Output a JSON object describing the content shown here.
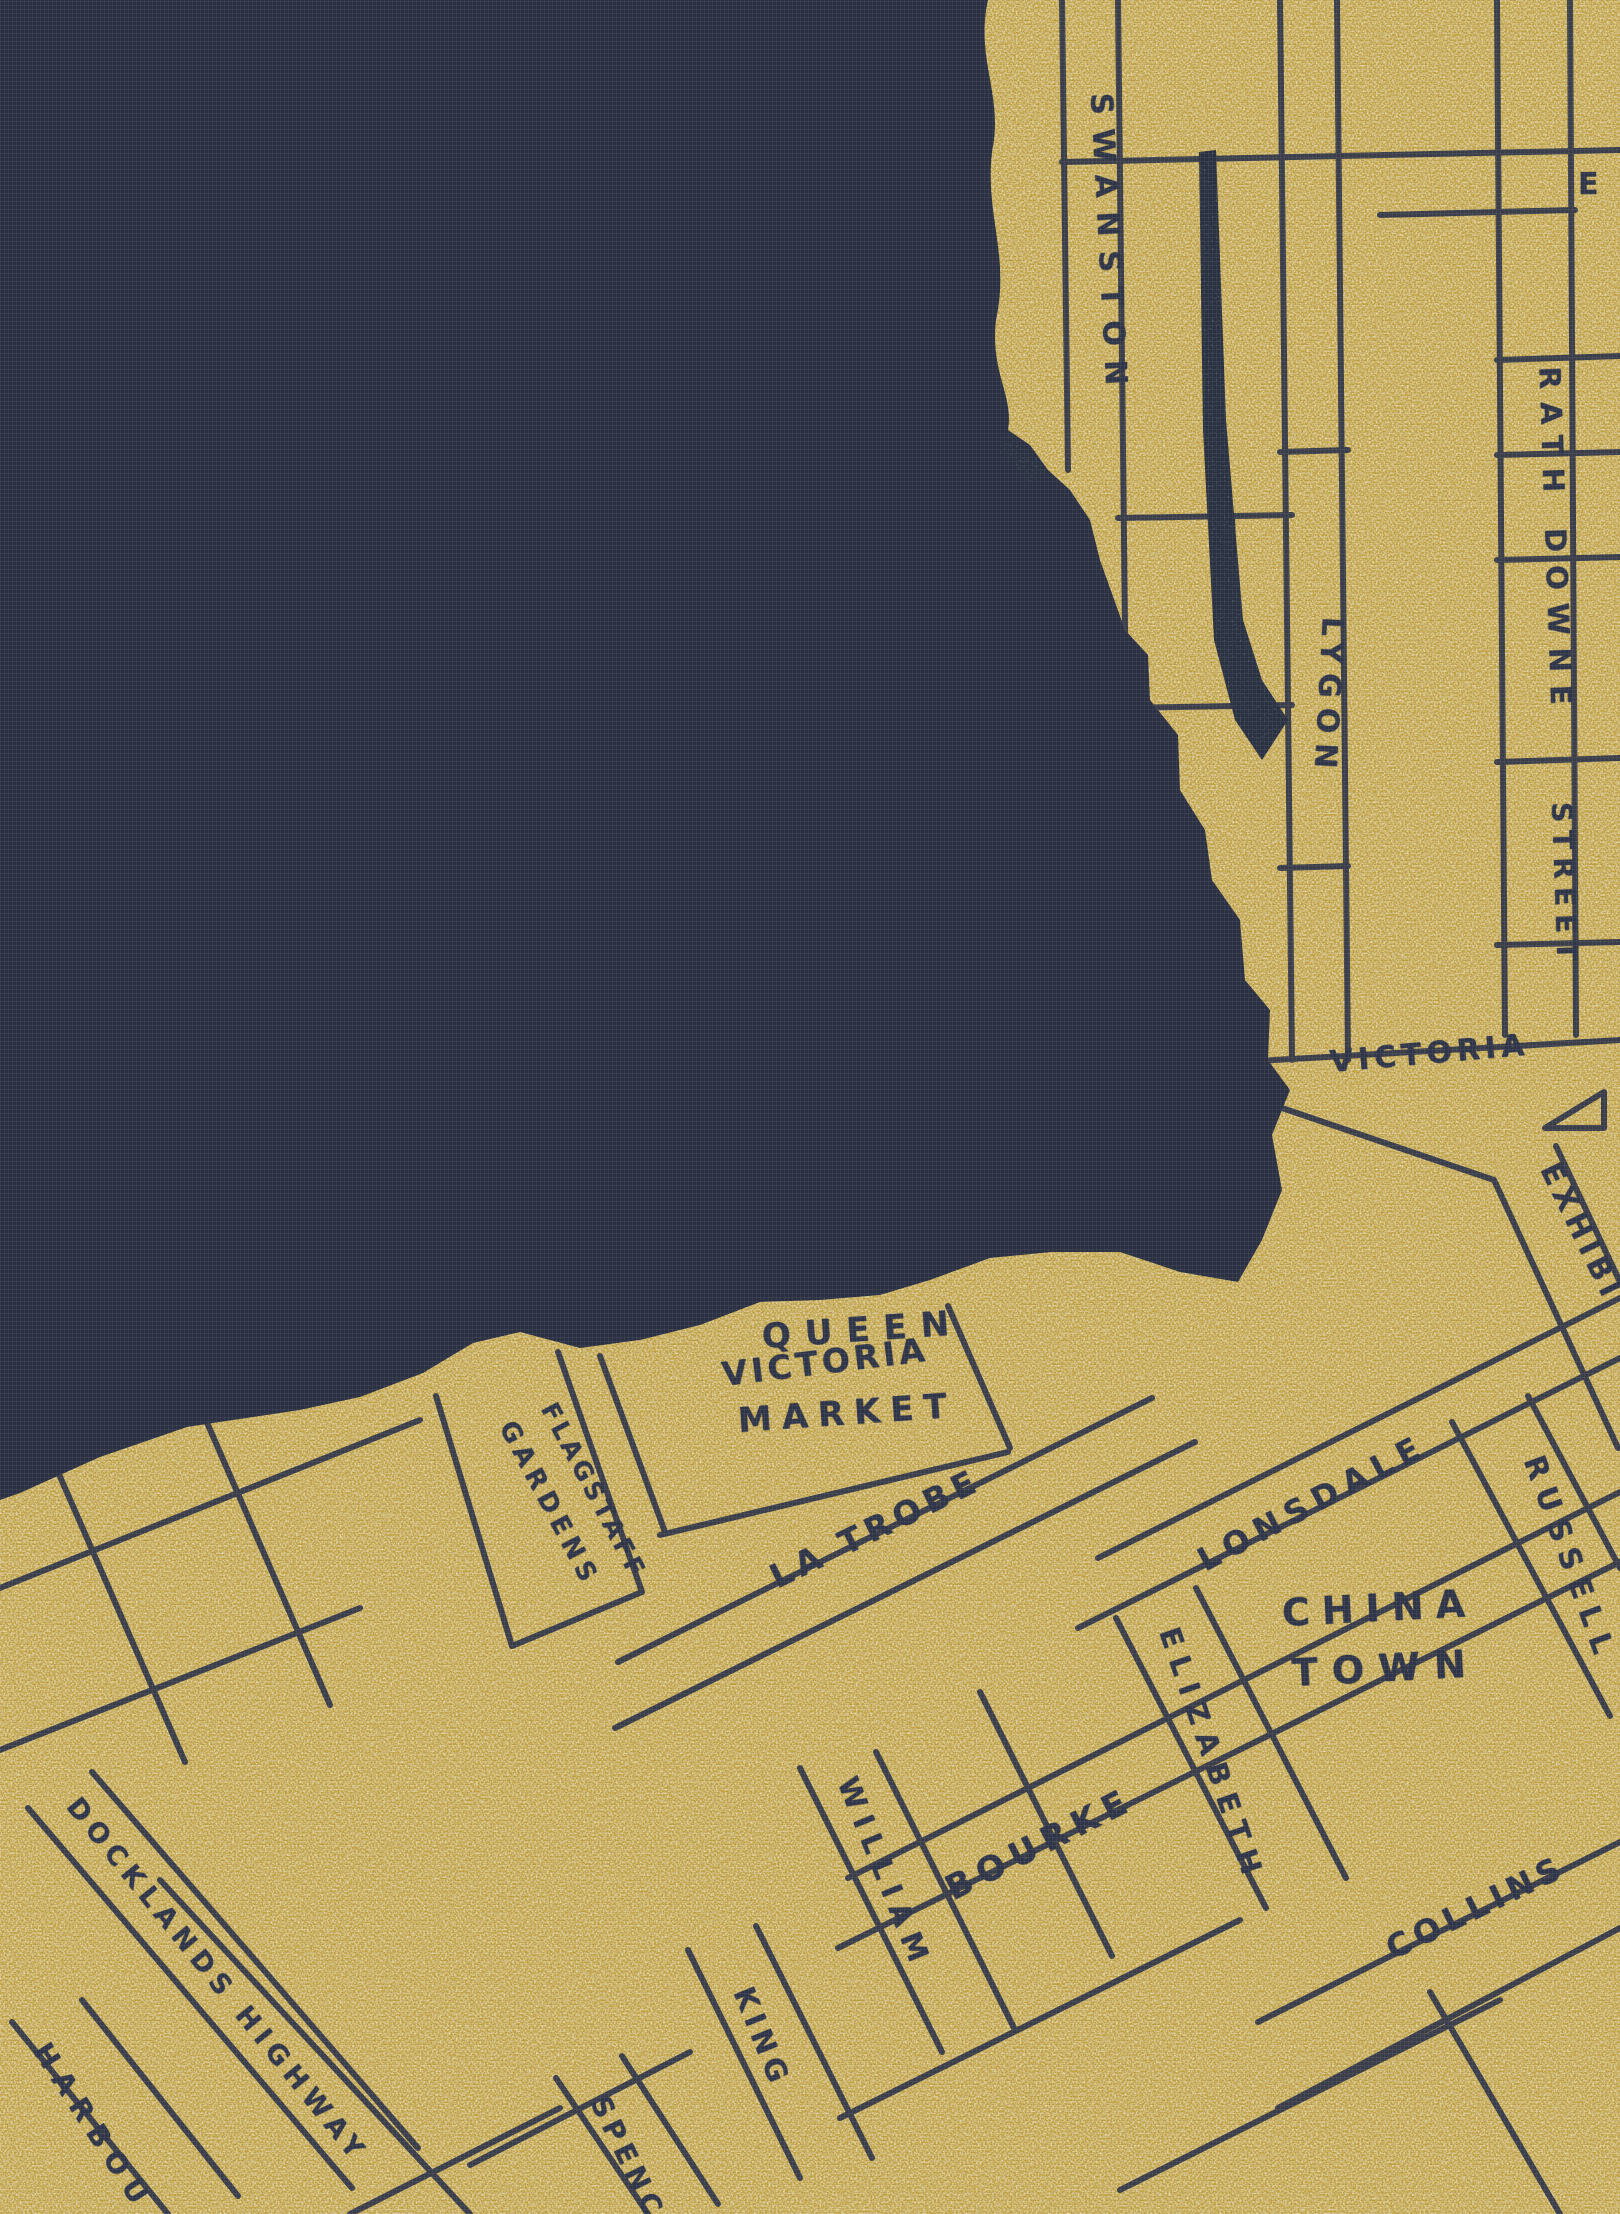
{
  "artwork": {
    "palette": {
      "background_navy": "#2b3143",
      "navy_weave_highlight": "#4a5168",
      "gold": "#c0a03a",
      "gold_speckle_light": "#efe09a",
      "gold_speckle_dark": "#6f652a",
      "ink": "#2f3548"
    },
    "labels": [
      {
        "id": "swanston",
        "kind": "street",
        "text": "SWANSTON",
        "x": 1100,
        "y": 78,
        "rotate": 87,
        "size": 30,
        "spacing": 14
      },
      {
        "id": "truncated-e",
        "kind": "street",
        "text": "E",
        "x": 1578,
        "y": 170,
        "rotate": 0,
        "size": 30,
        "spacing": 2
      },
      {
        "id": "rathdowne",
        "kind": "street",
        "text": "RATH DOWNE",
        "x": 1549,
        "y": 352,
        "rotate": 88,
        "size": 29,
        "spacing": 13
      },
      {
        "id": "rathdowne-street",
        "kind": "street",
        "text": "STREET",
        "x": 1561,
        "y": 788,
        "rotate": 88,
        "size": 28,
        "spacing": 8
      },
      {
        "id": "lygon",
        "kind": "street",
        "text": "LYGON",
        "x": 1332,
        "y": 602,
        "rotate": 93,
        "size": 30,
        "spacing": 10
      },
      {
        "id": "victoria",
        "kind": "street",
        "text": "VICTORIA",
        "x": 1330,
        "y": 1048,
        "rotate": -5,
        "size": 30,
        "spacing": 5
      },
      {
        "id": "exhibition",
        "kind": "street",
        "text": "EXHIBI",
        "x": 1548,
        "y": 1150,
        "rotate": 64,
        "size": 30,
        "spacing": 6
      },
      {
        "id": "queen-victoria-market-1",
        "kind": "area",
        "text": "QUEEN",
        "x": 762,
        "y": 1320,
        "rotate": -4,
        "size": 34,
        "spacing": 14
      },
      {
        "id": "queen-victoria-market-2",
        "kind": "area",
        "text": "VICTORIA",
        "x": 722,
        "y": 1358,
        "rotate": -7,
        "size": 33,
        "spacing": 4
      },
      {
        "id": "queen-victoria-market-3",
        "kind": "area",
        "text": "MARKET",
        "x": 738,
        "y": 1404,
        "rotate": -4,
        "size": 34,
        "spacing": 10
      },
      {
        "id": "flagstaff",
        "kind": "area",
        "text": "FLAGSTAFF",
        "x": 548,
        "y": 1392,
        "rotate": 62,
        "size": 25,
        "spacing": 4
      },
      {
        "id": "gardens",
        "kind": "area",
        "text": "GARDENS",
        "x": 506,
        "y": 1410,
        "rotate": 62,
        "size": 26,
        "spacing": 6
      },
      {
        "id": "la-trobe",
        "kind": "street",
        "text": "LA TROBE",
        "x": 772,
        "y": 1562,
        "rotate": -26,
        "size": 33,
        "spacing": 6
      },
      {
        "id": "lonsdale",
        "kind": "street",
        "text": "LONSDALE",
        "x": 1200,
        "y": 1546,
        "rotate": -28,
        "size": 32,
        "spacing": 8
      },
      {
        "id": "russell",
        "kind": "street",
        "text": "RUSSELL",
        "x": 1532,
        "y": 1442,
        "rotate": 70,
        "size": 30,
        "spacing": 10
      },
      {
        "id": "china-town-1",
        "kind": "area",
        "text": "CHINA",
        "x": 1282,
        "y": 1594,
        "rotate": -3,
        "size": 38,
        "spacing": 12
      },
      {
        "id": "china-town-2",
        "kind": "area",
        "text": "TOWN",
        "x": 1292,
        "y": 1654,
        "rotate": -3,
        "size": 38,
        "spacing": 14
      },
      {
        "id": "elizabeth",
        "kind": "street",
        "text": "ELIZABETH",
        "x": 1168,
        "y": 1614,
        "rotate": 71,
        "size": 29,
        "spacing": 10
      },
      {
        "id": "bourke",
        "kind": "street",
        "text": "BOURKE",
        "x": 948,
        "y": 1874,
        "rotate": -27,
        "size": 34,
        "spacing": 8
      },
      {
        "id": "william",
        "kind": "street",
        "text": "WILLIAM",
        "x": 846,
        "y": 1764,
        "rotate": 68,
        "size": 29,
        "spacing": 9
      },
      {
        "id": "king",
        "kind": "street",
        "text": "KING",
        "x": 742,
        "y": 1974,
        "rotate": 68,
        "size": 29,
        "spacing": 6
      },
      {
        "id": "collins",
        "kind": "street",
        "text": "COLLINS",
        "x": 1388,
        "y": 1934,
        "rotate": -26,
        "size": 32,
        "spacing": 6
      },
      {
        "id": "docklands-highway",
        "kind": "street",
        "text": "DOCKLANDS HIGHWAY",
        "x": 72,
        "y": 1788,
        "rotate": 51,
        "size": 27,
        "spacing": 7
      },
      {
        "id": "harbour",
        "kind": "street",
        "text": "HARBOU",
        "x": 40,
        "y": 2032,
        "rotate": 57,
        "size": 28,
        "spacing": 10
      },
      {
        "id": "spencer",
        "kind": "street",
        "text": "SPENC",
        "x": 598,
        "y": 2084,
        "rotate": 64,
        "size": 28,
        "spacing": 6
      }
    ]
  }
}
